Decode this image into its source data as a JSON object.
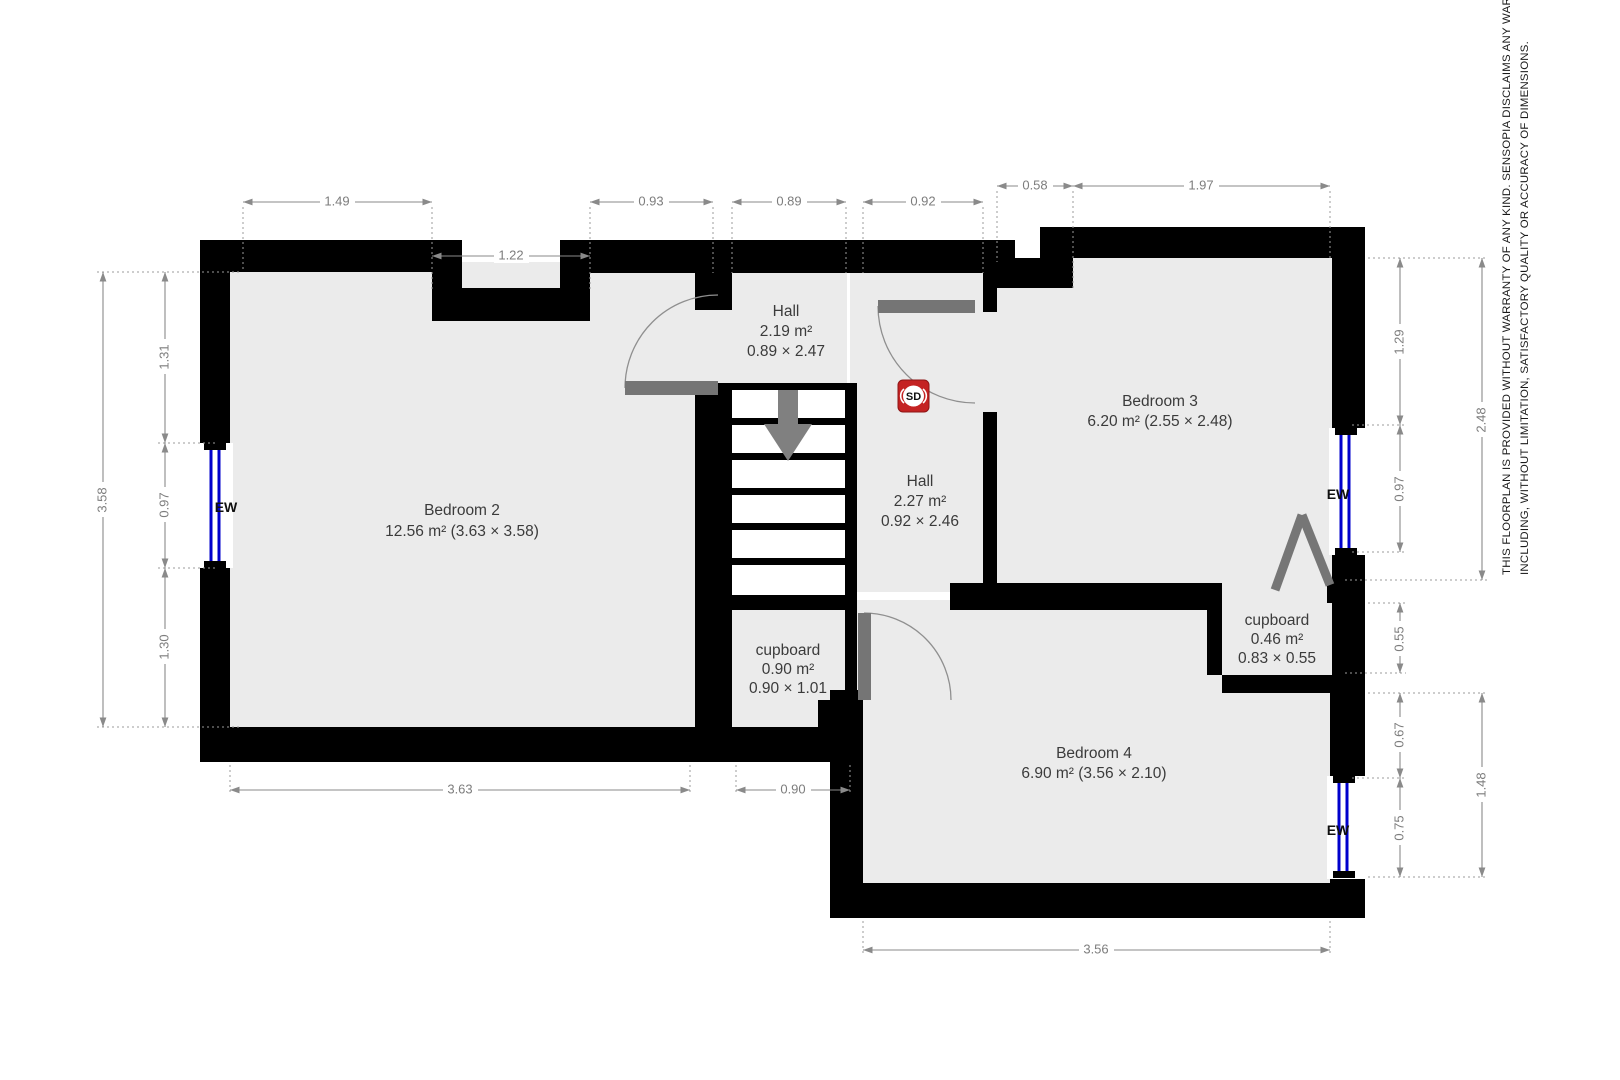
{
  "rooms": [
    {
      "id": "bedroom-2",
      "name": "Bedroom 2",
      "area": "12.56 m² (3.63 × 3.58)"
    },
    {
      "id": "hall-top",
      "name": "Hall",
      "area": "2.19 m²",
      "size": "0.89 × 2.47"
    },
    {
      "id": "hall-mid",
      "name": "Hall",
      "area": "2.27 m²",
      "size": "0.92 × 2.46"
    },
    {
      "id": "bedroom-3",
      "name": "Bedroom 3",
      "area": "6.20 m² (2.55 × 2.48)"
    },
    {
      "id": "cupboard-1",
      "name": "cupboard",
      "area": "0.90 m²",
      "size": "0.90 × 1.01"
    },
    {
      "id": "cupboard-2",
      "name": "cupboard",
      "area": "0.46 m²",
      "size": "0.83 × 0.55"
    },
    {
      "id": "bedroom-4",
      "name": "Bedroom 4",
      "area": "6.90 m² (3.56 × 2.10)"
    }
  ],
  "dims": {
    "top": {
      "d1": "1.49",
      "d2": "1.22",
      "d3": "0.93",
      "d4": "0.89",
      "d5": "0.92",
      "d6": "0.58",
      "d7": "1.97"
    },
    "left": {
      "d1": "3.58",
      "d2": "1.31",
      "d3": "0.97",
      "d4": "1.30"
    },
    "right": {
      "d1": "1.29",
      "d2": "0.97",
      "d3": "2.48",
      "d4": "0.55",
      "d5": "0.67",
      "d6": "0.75",
      "d7": "1.48"
    },
    "bottom": {
      "d1": "3.63",
      "d2": "0.90",
      "d3": "3.56"
    }
  },
  "markers": {
    "window_label": "EW",
    "smoke_detector": "SD"
  },
  "disclaimer": {
    "line1": "THIS FLOORPLAN IS PROVIDED WITHOUT WARRANTY OF ANY KIND. SENSOPIA DISCLAIMS ANY WARRANTY",
    "line2": "INCLUDING, WITHOUT LIMITATION, SATISFACTORY QUALITY OR ACCURACY OF DIMENSIONS."
  },
  "colors": {
    "wall": "#000000",
    "floor": "#ebebeb",
    "dimension": "#8a8a8a",
    "door": "#757575",
    "window": "#0000cc",
    "smoke_detector_bg": "#c42222"
  }
}
